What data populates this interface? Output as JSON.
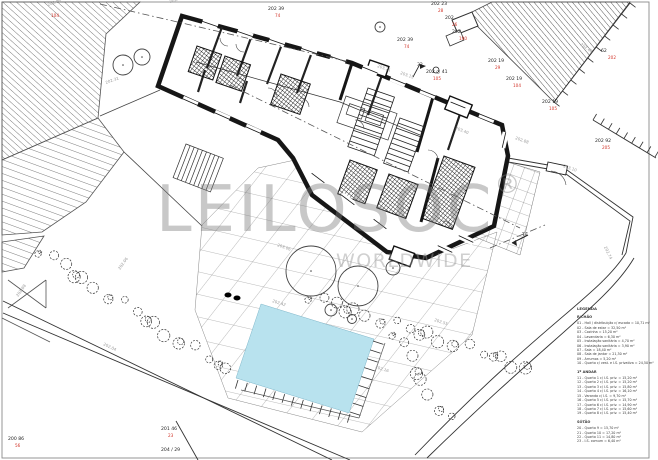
{
  "watermark": {
    "brand": "LEILOSOC",
    "registered": "®",
    "tagline": "WORLDWIDE"
  },
  "colors": {
    "pool_fill": "#b8e2ee",
    "survey_label_black": "#1d1d1d",
    "survey_label_red": "#d2352a",
    "spot_elevation_gray": "#9a9a9a",
    "line_ink": "#1c1c1c",
    "watermark_gray": "#9e9e9e"
  },
  "survey_labels": [
    {
      "x": 431,
      "y": 5,
      "main": "202  23",
      "sub": "28"
    },
    {
      "x": 445,
      "y": 19,
      "main": "202",
      "sub": "26"
    },
    {
      "x": 452,
      "y": 33,
      "main": "202",
      "sub": "190"
    },
    {
      "x": 397,
      "y": 41,
      "main": "202  39",
      "sub": "74"
    },
    {
      "x": 268,
      "y": 10,
      "main": "202  39",
      "sub": "74"
    },
    {
      "x": 426,
      "y": 73,
      "main": "202 ○ 41",
      "sub": "105"
    },
    {
      "x": 488,
      "y": 62,
      "main": "202  19",
      "sub": "29"
    },
    {
      "x": 506,
      "y": 80,
      "main": "202  19",
      "sub": "104"
    },
    {
      "x": 601,
      "y": 52,
      "main": "62",
      "sub": "202"
    },
    {
      "x": 542,
      "y": 103,
      "main": "202  19",
      "sub": "105"
    },
    {
      "x": 595,
      "y": 142,
      "main": "202  92",
      "sub": "205"
    },
    {
      "x": 8,
      "y": 440,
      "main": "200  86",
      "sub": "56"
    },
    {
      "x": 161,
      "y": 430,
      "main": "201  46",
      "sub": "23"
    },
    {
      "x": 161,
      "y": 451,
      "main": "204 / 29",
      "sub": ""
    },
    {
      "x": 44,
      "y": 10,
      "main": "",
      "sub": "104"
    },
    {
      "x": 417,
      "y": 66,
      "main": "32",
      "sub": ""
    },
    {
      "x": 522,
      "y": 236,
      "main": "Tv",
      "sub": ""
    }
  ],
  "spot_elevations": [
    {
      "x": 48,
      "y": 6,
      "rot": -18,
      "value": "202.06"
    },
    {
      "x": 170,
      "y": 3,
      "rot": -18,
      "value": "202.15"
    },
    {
      "x": 106,
      "y": 84,
      "rot": -20,
      "value": "202.31"
    },
    {
      "x": 120,
      "y": 270,
      "rot": -55,
      "value": "202.06"
    },
    {
      "x": 18,
      "y": 297,
      "rot": -55,
      "value": "202.88"
    },
    {
      "x": 103,
      "y": 345,
      "rot": 26,
      "value": "202.04"
    },
    {
      "x": 277,
      "y": 246,
      "rot": 20,
      "value": "203.06"
    },
    {
      "x": 272,
      "y": 302,
      "rot": 18,
      "value": "202.42"
    },
    {
      "x": 375,
      "y": 368,
      "rot": 18,
      "value": "202.16"
    },
    {
      "x": 434,
      "y": 321,
      "rot": 18,
      "value": "202.55"
    },
    {
      "x": 515,
      "y": 139,
      "rot": 20,
      "value": "202.88"
    },
    {
      "x": 563,
      "y": 167,
      "rot": 20,
      "value": "203.10"
    },
    {
      "x": 604,
      "y": 247,
      "rot": 65,
      "value": "202.74"
    },
    {
      "x": 377,
      "y": 67,
      "rot": 20,
      "value": "203.21"
    },
    {
      "x": 400,
      "y": 74,
      "rot": 20,
      "value": "203.15"
    },
    {
      "x": 455,
      "y": 129,
      "rot": 22,
      "value": "203.40"
    },
    {
      "x": 580,
      "y": 45,
      "rot": 35,
      "value": "202.42"
    }
  ],
  "legend": {
    "title": "LEGENDA",
    "sections": [
      {
        "header": "R/CHÃO",
        "items": [
          "01 - Hall / distribuição c/ escada = 10,71 m²",
          "02 - Sala de estar = 32,50 m²",
          "03 - Cozinha = 15,20 m²",
          "04 - Lavandaria = 6,30 m²",
          "05 - Instalação sanitária = 4,70 m²",
          "06 - Instalação sanitária = 3,90 m²",
          "07 - Sala = 18,40 m²",
          "08 - Sala de jantar = 21,30 m²",
          "09 - Arrumos = 5,20 m²",
          "10 - Quarto c/ vest. e I.S. privativa = 24,50 m²"
        ]
      },
      {
        "header": "1º ANDAR",
        "items": [
          "11 - Quarto 1 c/ I.S. priv. = 15,20 m²",
          "12 - Quarto 2 c/ I.S. priv. = 15,20 m²",
          "13 - Quarto 3 c/ I.S. priv. = 15,80 m²",
          "14 - Quarto 4 c/ I.S. priv. = 16,10 m²",
          "15 - Varanda c/ I.S. = 9,70 m²",
          "16 - Quarto 5 c/ I.S. priv. = 15,70 m²",
          "17 - Quarto 6 c/ I.S. priv. = 14,90 m²",
          "18 - Quarto 7 c/ I.S. priv. = 15,60 m²",
          "19 - Quarto 8 c/ I.S. priv. = 15,40 m²"
        ]
      },
      {
        "header": "SÓTÃO",
        "items": [
          "20 - Quarto 9 = 15,70 m²",
          "21 - Quarto 10 = 17,20 m²",
          "22 - Quarto 11 = 14,80 m²",
          "23 - I.S. comum = 6,40 m²"
        ]
      }
    ]
  }
}
